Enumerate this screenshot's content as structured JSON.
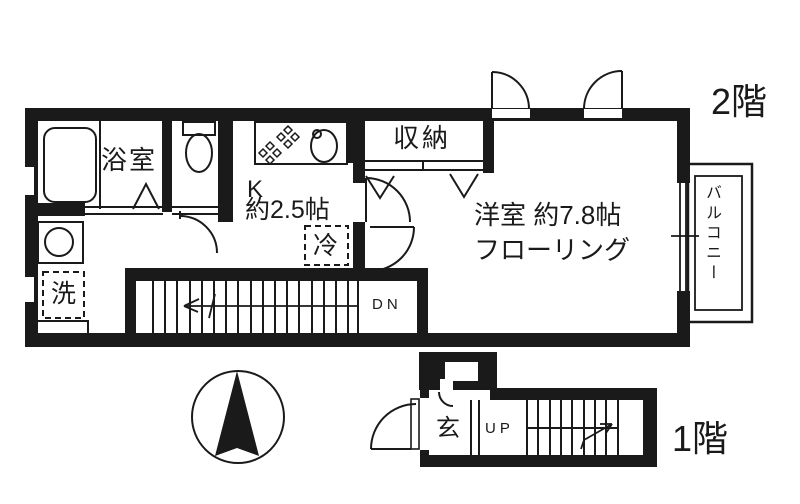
{
  "colors": {
    "ink": "#1a1a1a",
    "background": "#ffffff"
  },
  "floor2": {
    "label": "2階",
    "rooms": {
      "bathroom": {
        "label": "浴室"
      },
      "kitchen": {
        "label": "K",
        "size": "約2.5帖"
      },
      "refrigerator": {
        "label": "冷"
      },
      "storage": {
        "label": "収納"
      },
      "western_room": {
        "label": "洋室 約7.8帖",
        "floor_type": "フローリング"
      },
      "balcony": {
        "label": "バルコニー"
      },
      "laundry": {
        "label": "洗"
      }
    },
    "stairs": {
      "label": "DN"
    }
  },
  "floor1": {
    "label": "1階",
    "rooms": {
      "entrance": {
        "label": "玄"
      }
    },
    "stairs": {
      "label": "UP"
    }
  }
}
